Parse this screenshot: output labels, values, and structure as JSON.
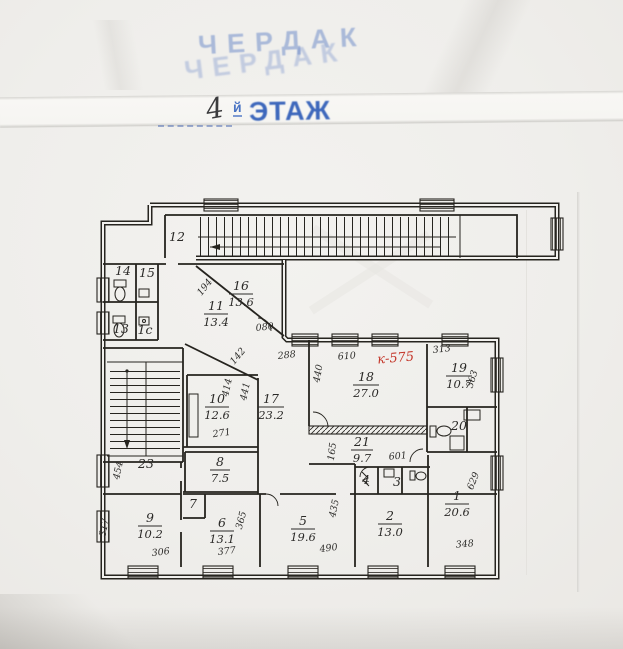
{
  "document": {
    "attic_stamp": {
      "line1": "ЧЕРДАК",
      "line2": "ЧЕРДАК"
    },
    "floor_title": {
      "number": "4",
      "suffix": "й",
      "word": "ЭТАЖ"
    },
    "annotation_red": "к-575"
  },
  "colors": {
    "paper": "#efeeeb",
    "ink": "#26241f",
    "stamp_blue": "#3e68bc",
    "stamp_blue_faded": "#6484c6",
    "annotation_red": "#c4372a"
  },
  "plan": {
    "rooms": [
      {
        "number": "1",
        "area": "20.6"
      },
      {
        "number": "2",
        "area": "13.0"
      },
      {
        "number": "3"
      },
      {
        "number": "4"
      },
      {
        "number": "5",
        "area": "19.6"
      },
      {
        "number": "6",
        "area": "13.1"
      },
      {
        "number": "7"
      },
      {
        "number": "8",
        "area": "7.5"
      },
      {
        "number": "9",
        "area": "10.2"
      },
      {
        "number": "10",
        "area": "12.6"
      },
      {
        "number": "11",
        "area": "13.4"
      },
      {
        "number": "12"
      },
      {
        "number": "13"
      },
      {
        "number": "14"
      },
      {
        "number": "15"
      },
      {
        "number": "1с"
      },
      {
        "number": "16",
        "area": "13.6"
      },
      {
        "number": "17",
        "area": "23.2"
      },
      {
        "number": "18",
        "area": "27.0"
      },
      {
        "number": "19",
        "area": "10.7"
      },
      {
        "number": "20"
      },
      {
        "number": "21",
        "area": "9.7"
      },
      {
        "number": "23"
      }
    ],
    "dims": [
      {
        "text": "610"
      },
      {
        "text": "440"
      },
      {
        "text": "313"
      },
      {
        "text": "363"
      },
      {
        "text": "194"
      },
      {
        "text": "080"
      },
      {
        "text": "142"
      },
      {
        "text": "288"
      },
      {
        "text": "414"
      },
      {
        "text": "441"
      },
      {
        "text": "271"
      },
      {
        "text": "165"
      },
      {
        "text": "601"
      },
      {
        "text": "454"
      },
      {
        "text": "317"
      },
      {
        "text": "306"
      },
      {
        "text": "377"
      },
      {
        "text": "365"
      },
      {
        "text": "490"
      },
      {
        "text": "435"
      },
      {
        "text": "348"
      },
      {
        "text": "629"
      }
    ]
  }
}
